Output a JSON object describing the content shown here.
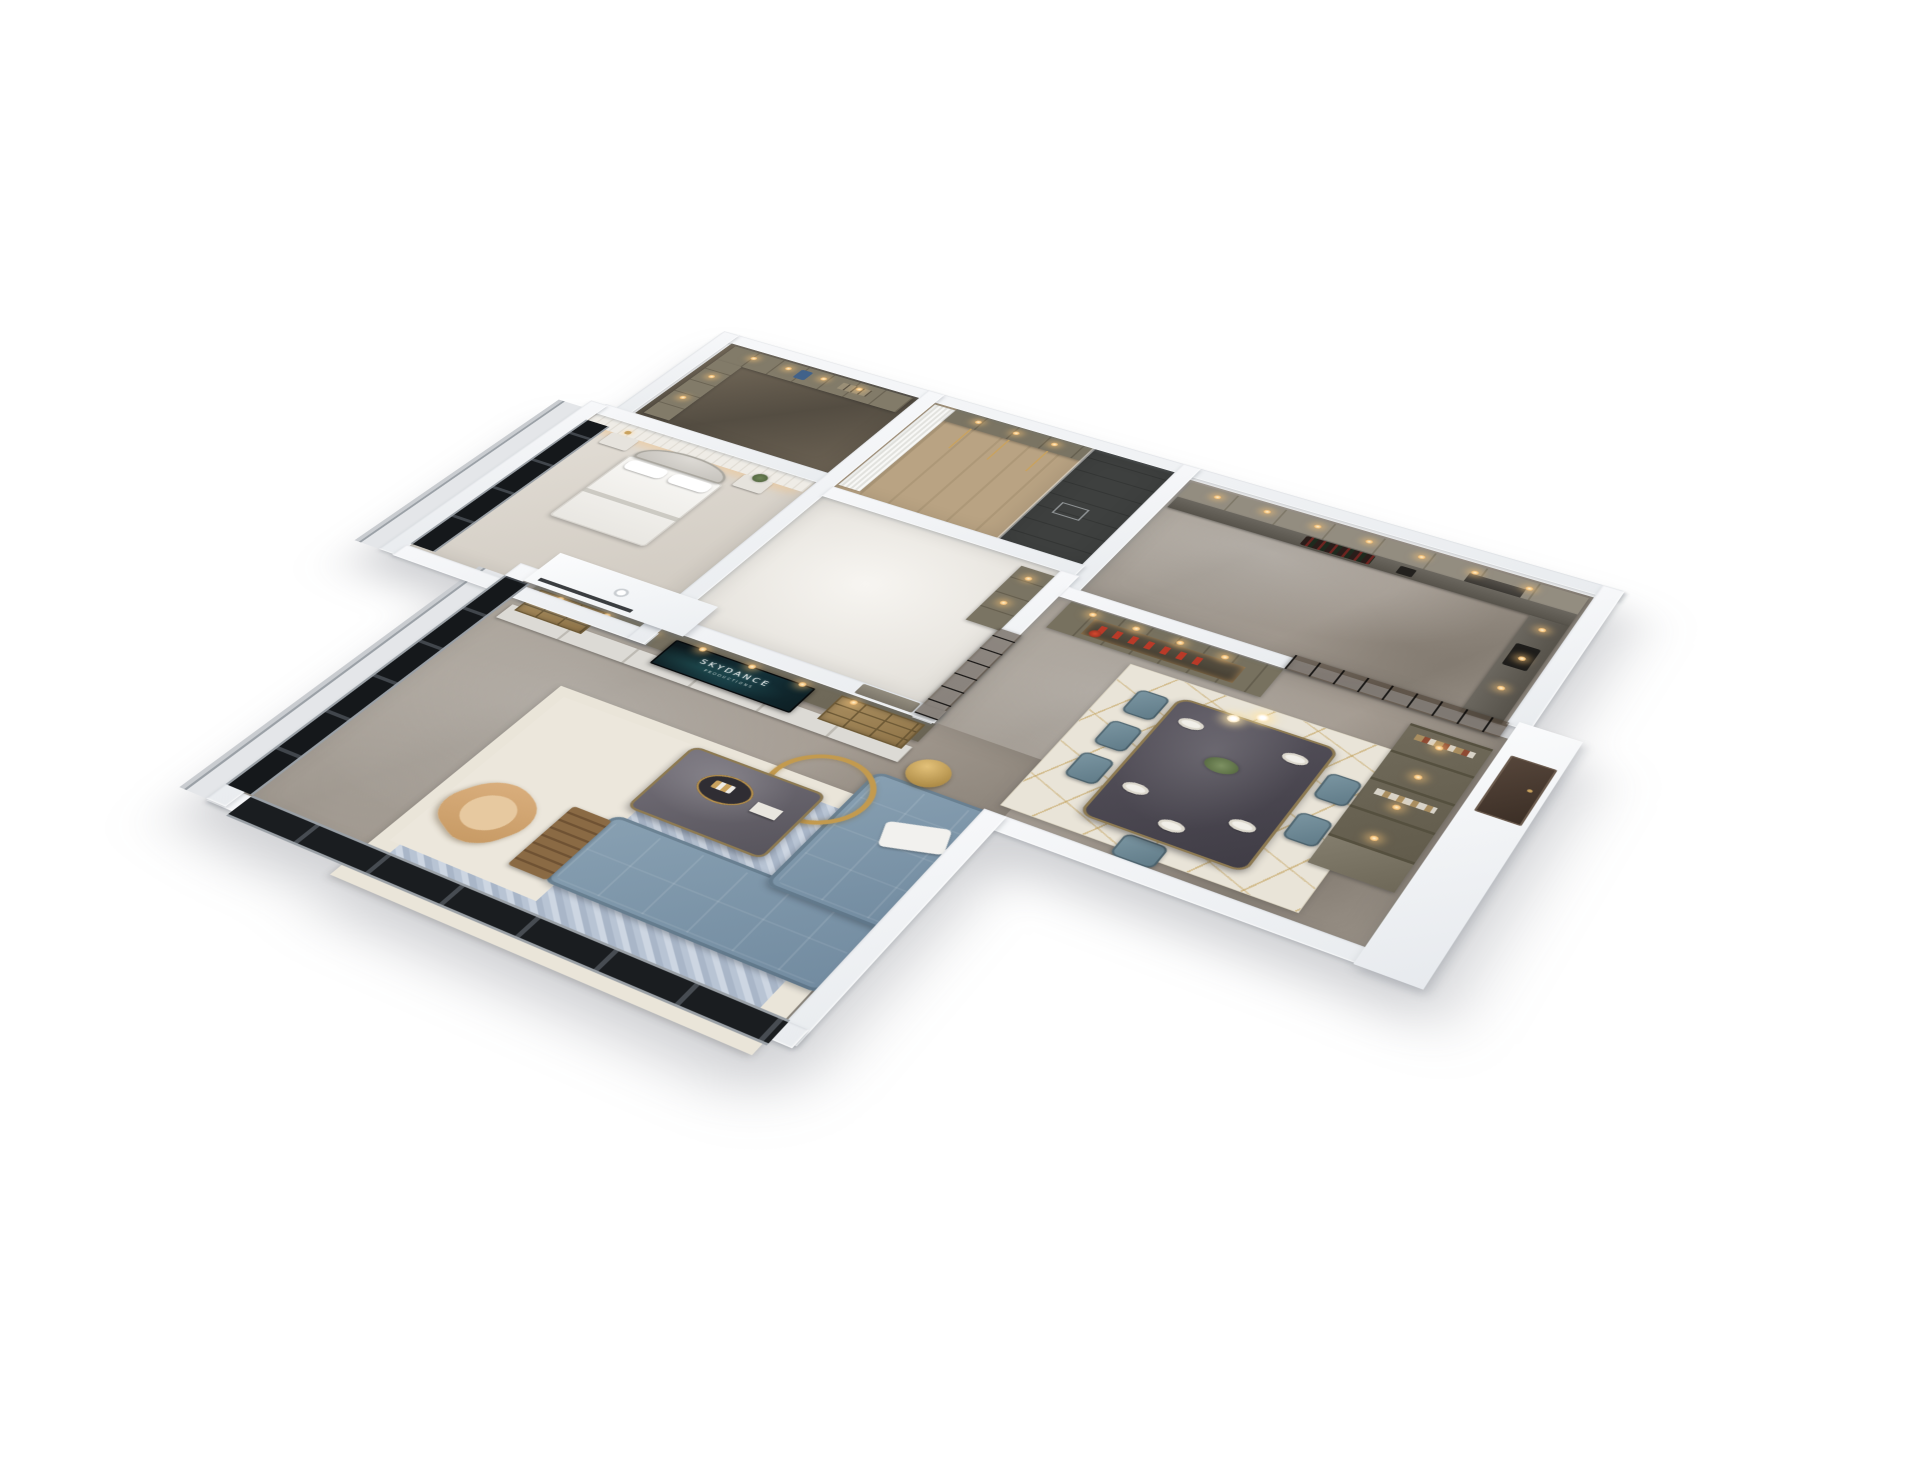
{
  "scene": {
    "type": "isometric-3d-apartment-floorplan-render",
    "background": "#ffffff",
    "tv": {
      "logo": "SKYDANCE",
      "subtitle": "PRODUCTIONS"
    },
    "palette": {
      "wall_white": "#f1f3f5",
      "floor_marble_gray": "#a29a90",
      "floor_wood": "#b7a182",
      "floor_bath_dark": "#3e403f",
      "cabinet_olive": "#6f6959",
      "shelf_wood": "#a98e60",
      "sofa_slate_blue": "#7e96a8",
      "dining_chair_teal": "#6d8894",
      "accent_gold": "#c39a4e",
      "accent_chair_tan": "#d3a876",
      "glass_partition_dark": "#1f1c19",
      "decor_red": "#b93a28",
      "downlight_warm": "#f3bd72",
      "tv_screen_teal": "#143139",
      "entry_door_walnut": "#4a3b31",
      "rug_living_blue": "#b8c4d4",
      "rug_border_cream": "#eae5d9"
    },
    "rooms": [
      {
        "name": "walk-in-closet",
        "features": [
          "olive wardrobe cubbies",
          "hanging clothes",
          "warm downlights",
          "dark glossy floor"
        ]
      },
      {
        "name": "dressing-room",
        "features": [
          "sheer white curtain wall",
          "wardrobe with gold rails",
          "wood floor"
        ]
      },
      {
        "name": "bathroom",
        "features": [
          "dark tile shower floor",
          "floor drain",
          "glass partition"
        ]
      },
      {
        "name": "kitchen",
        "features": [
          "upper cabinets with downlights",
          "counter with wine bottles",
          "knife block",
          "range hood",
          "black-framed glass sliding doors"
        ]
      },
      {
        "name": "master-bedroom",
        "features": [
          "arched quatrefoil headboard bed",
          "white pillows and duvet",
          "nightstands",
          "green plant",
          "marble accent wall with LED cove glow",
          "dark floor-to-ceiling windows"
        ]
      },
      {
        "name": "second-bedroom",
        "features": [
          "bright floor",
          "wardrobe",
          "interior door"
        ]
      },
      {
        "name": "dining-room",
        "features": [
          "dark marble dining table",
          "six teal upholstered chairs",
          "white place settings",
          "flower centerpiece",
          "double-globe pendant",
          "gold-lined cream rug",
          "wine display cabinet with red glassware",
          "tall bookshelf cabinet"
        ]
      },
      {
        "name": "living-room",
        "features": [
          "media wall with TV",
          "open wood shelving",
          "white lower drawers",
          "L-shaped slate-blue sectional sofa",
          "white throw",
          "dark coffee table with round tray",
          "wood magazine rack",
          "tan barrel accent chair",
          "gold ring sculpture",
          "gold round side table",
          "blue patterned rug with cream border",
          "white ceiling bulkhead with recessed light",
          "floor-to-ceiling corner windows"
        ]
      },
      {
        "name": "entry",
        "features": [
          "walnut entry door",
          "white exterior facade"
        ]
      }
    ]
  }
}
